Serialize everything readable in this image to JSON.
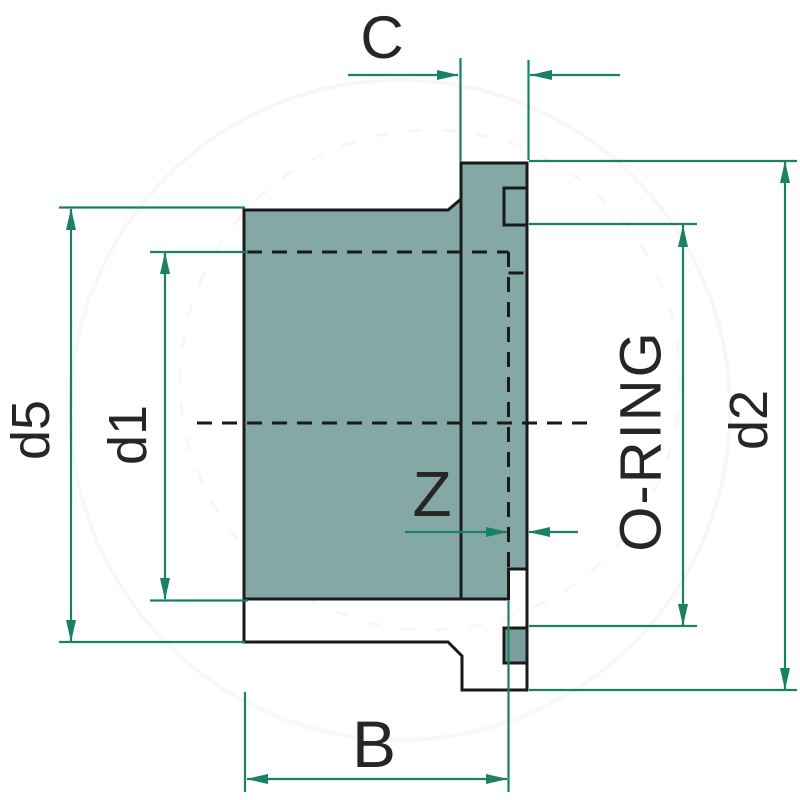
{
  "drawing": {
    "labels": {
      "c": "C",
      "d5": "d5",
      "d1": "d1",
      "z": "Z",
      "oring": "O-RING",
      "d2": "d2",
      "b": "B"
    },
    "colors": {
      "dimension": "#1A8165",
      "outline": "#1A1A1A",
      "body_fill": "#84A8A6",
      "hatch_fill": "#CDD9D6",
      "oring_fill": "#7A9E9C",
      "background": "#FFFFFF",
      "label_ink": "#262626"
    }
  }
}
